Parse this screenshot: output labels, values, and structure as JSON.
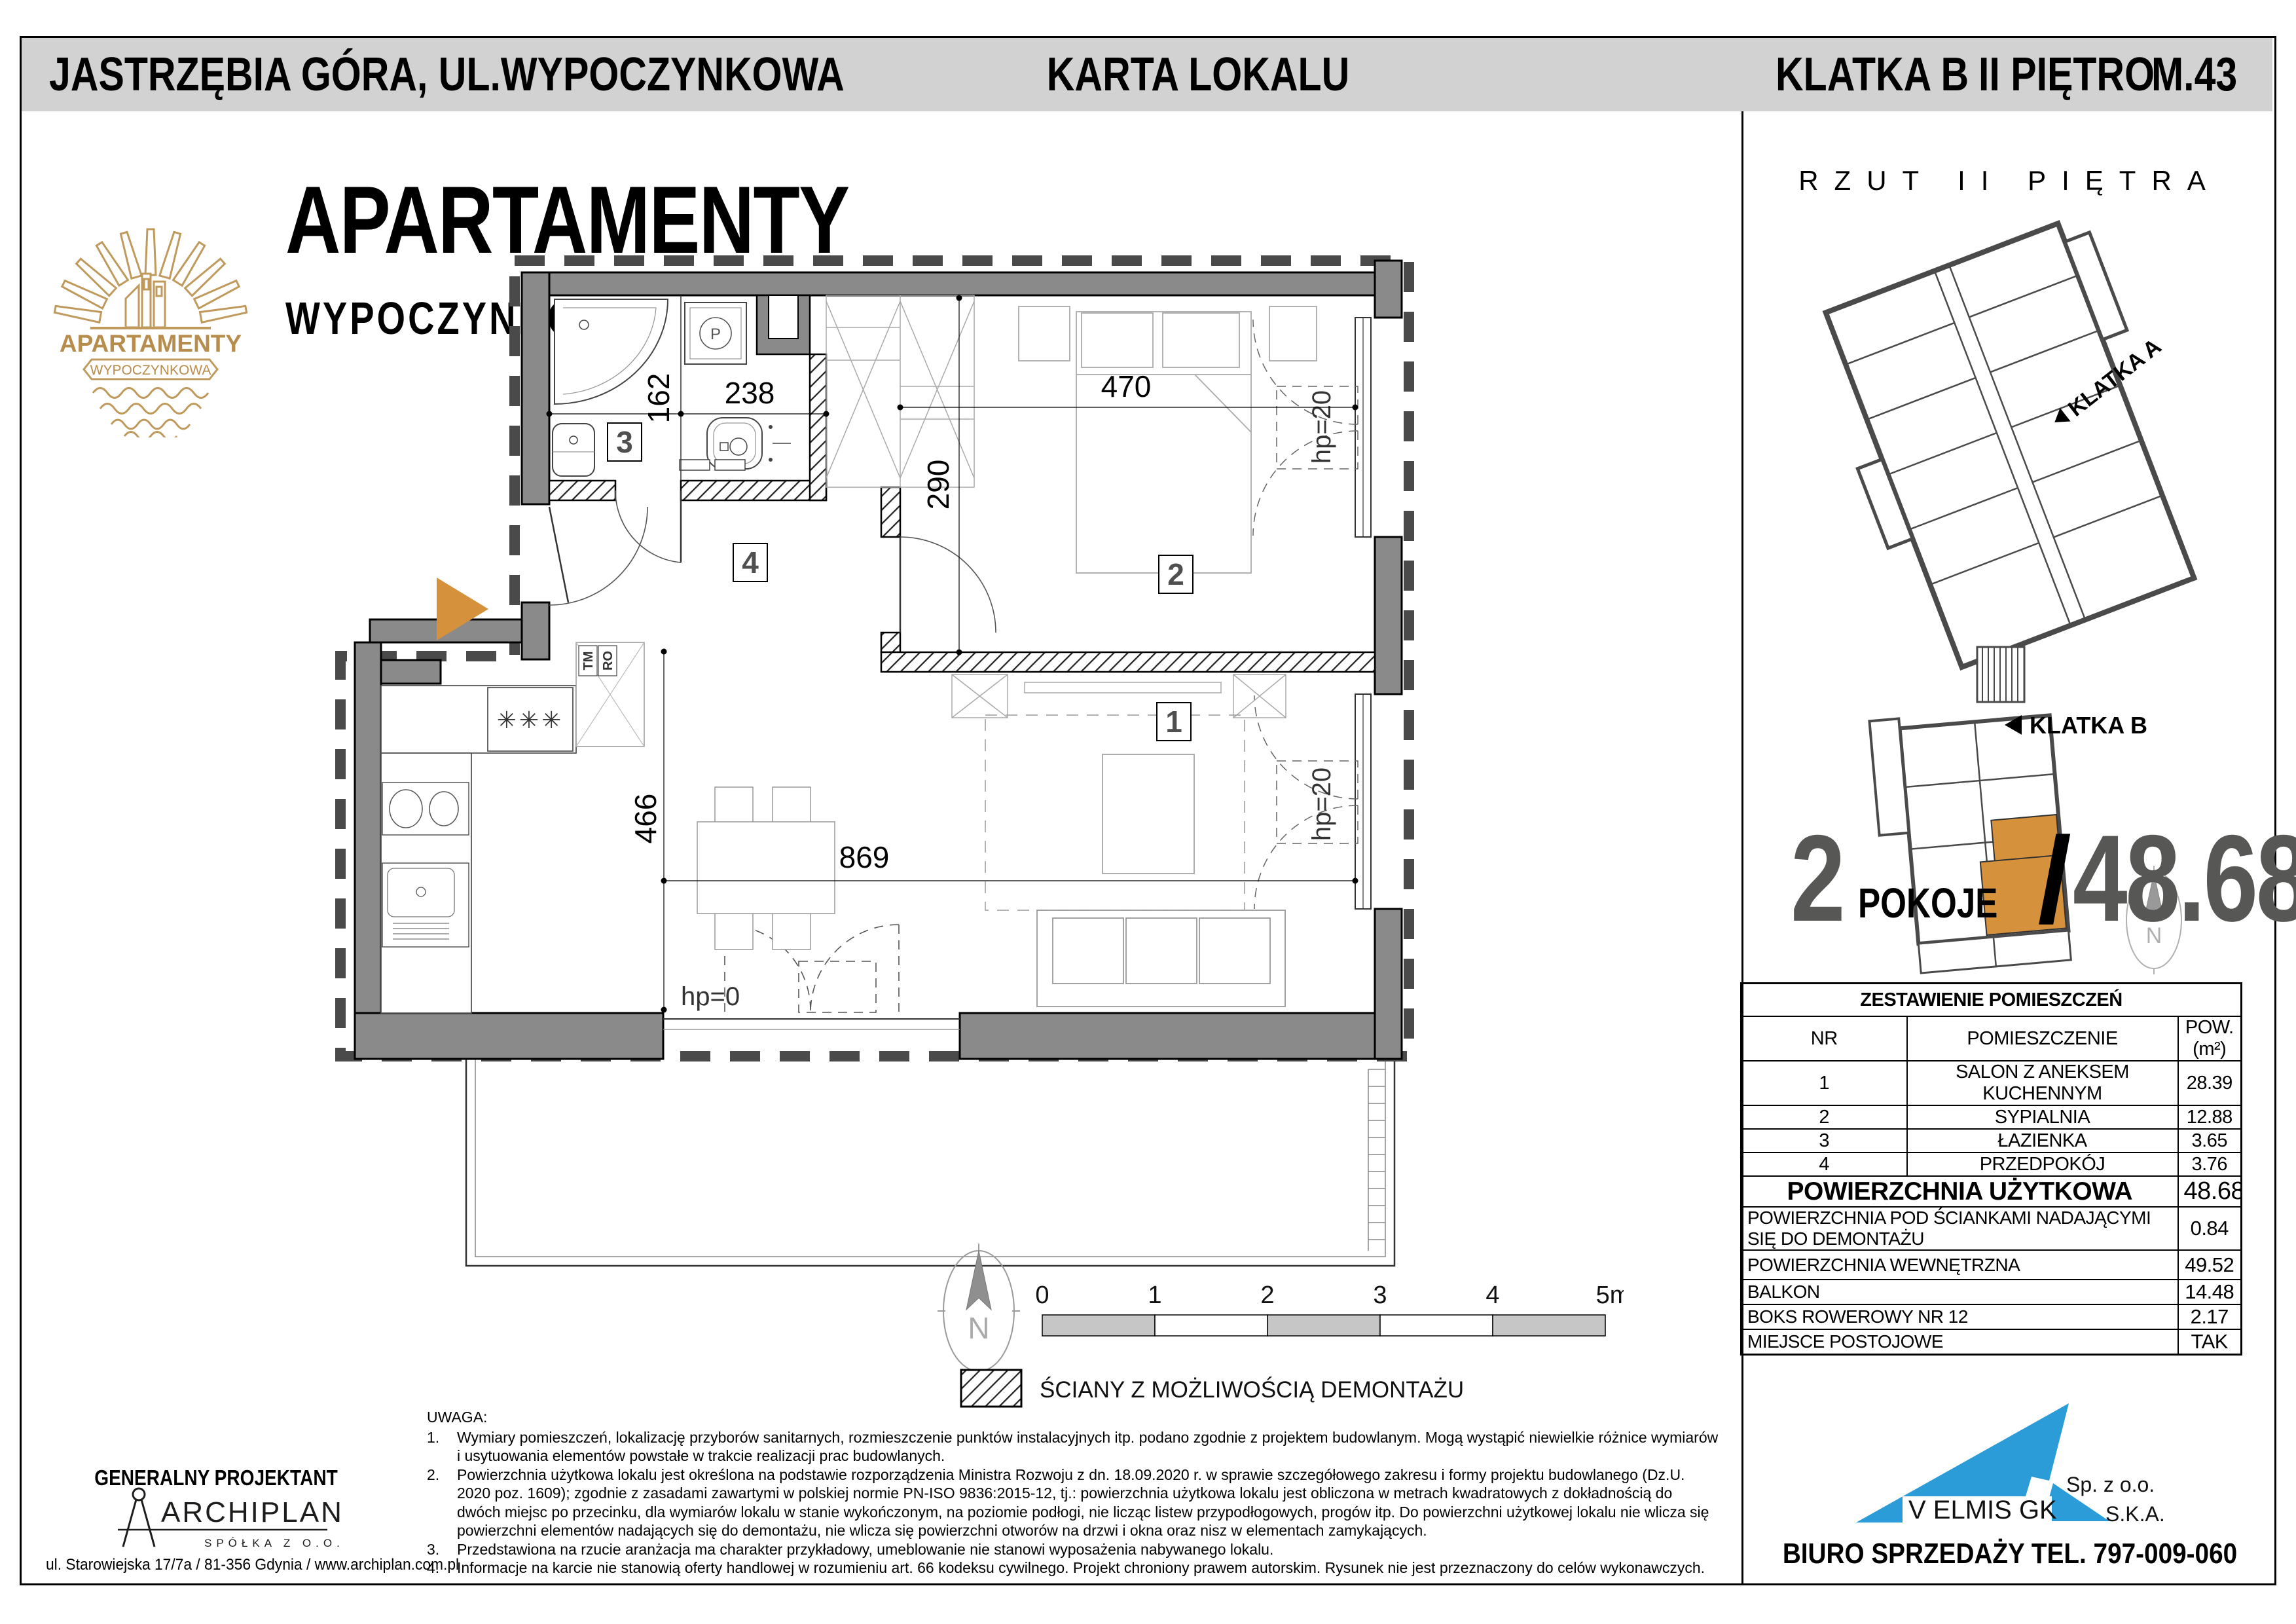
{
  "header": {
    "location": "JASTRZĘBIA GÓRA, UL.WYPOCZYNKOWA",
    "card_title": "KARTA LOKALU",
    "staircase": "KLATKA B",
    "floor": "II PIĘTRO",
    "unit": "M.43"
  },
  "brand": {
    "logo_word": "APARTAMENTY",
    "logo_banner": "WYPOCZYNKOWA",
    "title": "APARTAMENTY",
    "subtitle": "WYPOCZYNKOWA"
  },
  "plan": {
    "rooms": {
      "r1": "1",
      "r2": "2",
      "r3": "3",
      "r4": "4"
    },
    "dims": {
      "d162": "162",
      "d238": "238",
      "d470": "470",
      "d290": "290",
      "d466": "466",
      "d869": "869",
      "hp20": "hp=20",
      "hp0": "hp=0"
    },
    "kitchen": {
      "stove_symbol": "✳✳✳",
      "fridge_top": "TM",
      "fridge_bottom": "RO"
    },
    "bathroom": {
      "washer_label": "P"
    },
    "north_label": "N",
    "scale": [
      "0",
      "1",
      "2",
      "3",
      "4",
      "5m"
    ],
    "legend": "ŚCIANY Z MOŻLIWOŚCIĄ DEMONTAŻU"
  },
  "site_plan": {
    "title": "RZUT II PIĘTRA",
    "klatka_a": "KLATKA A",
    "klatka_b": "KLATKA B",
    "north": "N"
  },
  "summary": {
    "rooms_count": "2",
    "rooms_label": "POKOJE",
    "slash": "/",
    "area": "48.68",
    "area_unit": "m²"
  },
  "table": {
    "title": "ZESTAWIENIE POMIESZCZEŃ",
    "col_nr": "NR",
    "col_room": "POMIESZCZENIE",
    "col_area_1": "POW.",
    "col_area_2": "(m²)",
    "rows": [
      {
        "nr": "1",
        "name": "SALON Z ANEKSEM KUCHENNYM",
        "area": "28.39"
      },
      {
        "nr": "2",
        "name": "SYPIALNIA",
        "area": "12.88"
      },
      {
        "nr": "3",
        "name": "ŁAZIENKA",
        "area": "3.65"
      },
      {
        "nr": "4",
        "name": "PRZEDPOKÓJ",
        "area": "3.76"
      }
    ],
    "total_label": "POWIERZCHNIA UŻYTKOWA",
    "total_value": "48.68",
    "extra_rows": [
      {
        "label": "POWIERZCHNIA POD ŚCIANKAMI NADAJĄCYMI SIĘ DO DEMONTAŻU",
        "value": "0.84"
      },
      {
        "label": "POWIERZCHNIA WEWNĘTRZNA",
        "value": "49.52"
      },
      {
        "label": "BALKON",
        "value": "14.48"
      },
      {
        "label": "BOKS ROWEROWY NR 12",
        "value": "2.17"
      },
      {
        "label": "MIEJSCE POSTOJOWE",
        "value": "TAK"
      }
    ]
  },
  "notes": {
    "title": "UWAGA:",
    "items": [
      "Wymiary pomieszczeń, lokalizację przyborów sanitarnych, rozmieszczenie punktów instalacyjnych itp. podano zgodnie z projektem budowlanym. Mogą wystąpić niewielkie różnice wymiarów i usytuowania elementów powstałe w trakcie realizacji prac budowlanych.",
      "Powierzchnia użytkowa lokalu jest określona na podstawie rozporządzenia Ministra Rozwoju z dn. 18.09.2020 r. w sprawie szczegółowego zakresu i formy projektu budowlanego (Dz.U. 2020 poz. 1609); zgodnie z zasadami zawartymi w polskiej normie PN-ISO 9836:2015-12, tj.: powierzchnia użytkowa lokalu jest obliczona w metrach kwadratowych z dokładnością do dwóch miejsc po przecinku, dla wymiarów lokalu w stanie wykończonym, na poziomie podłogi, nie licząc listew przypodłogowych, progów itp. Do powierzchni użytkowej lokalu nie wlicza się powierzchni elementów nadających się do demontażu, nie wlicza się powierzchni otworów na drzwi i okna oraz nisz w elementach zamykających.",
      "Przedstawiona na rzucie aranżacja ma charakter przykładowy, umeblowanie nie stanowi wyposażenia nabywanego lokalu.",
      "Informacje na karcie nie stanowią oferty handlowej w rozumieniu art. 66 kodeksu cywilnego. Projekt chroniony prawem autorskim. Rysunek nie jest przeznaczony do celów wykonawczych."
    ]
  },
  "designer": {
    "heading": "GENERALNY PROJEKTANT",
    "name": "ARCHIPLAN",
    "sub": "SPÓŁKA Z O.O.",
    "address": "ul. Starowiejska 17/7a  /  81-356 Gdynia  /  www.archiplan.com.pl"
  },
  "seller": {
    "company": "V ELMIS GK",
    "suffix1": "Sp. z o.o.",
    "suffix2": "S.K.A.",
    "contact": "BIURO SPRZEDAŻY TEL. 797-009-060"
  },
  "colors": {
    "accent_orange": "#d6913d",
    "brand_gold": "#bf9256",
    "logo_blue": "#2b9cd8",
    "wall_gray": "#8a8a8a",
    "header_gray": "#d2d2d2",
    "digit_gray": "#575756"
  }
}
